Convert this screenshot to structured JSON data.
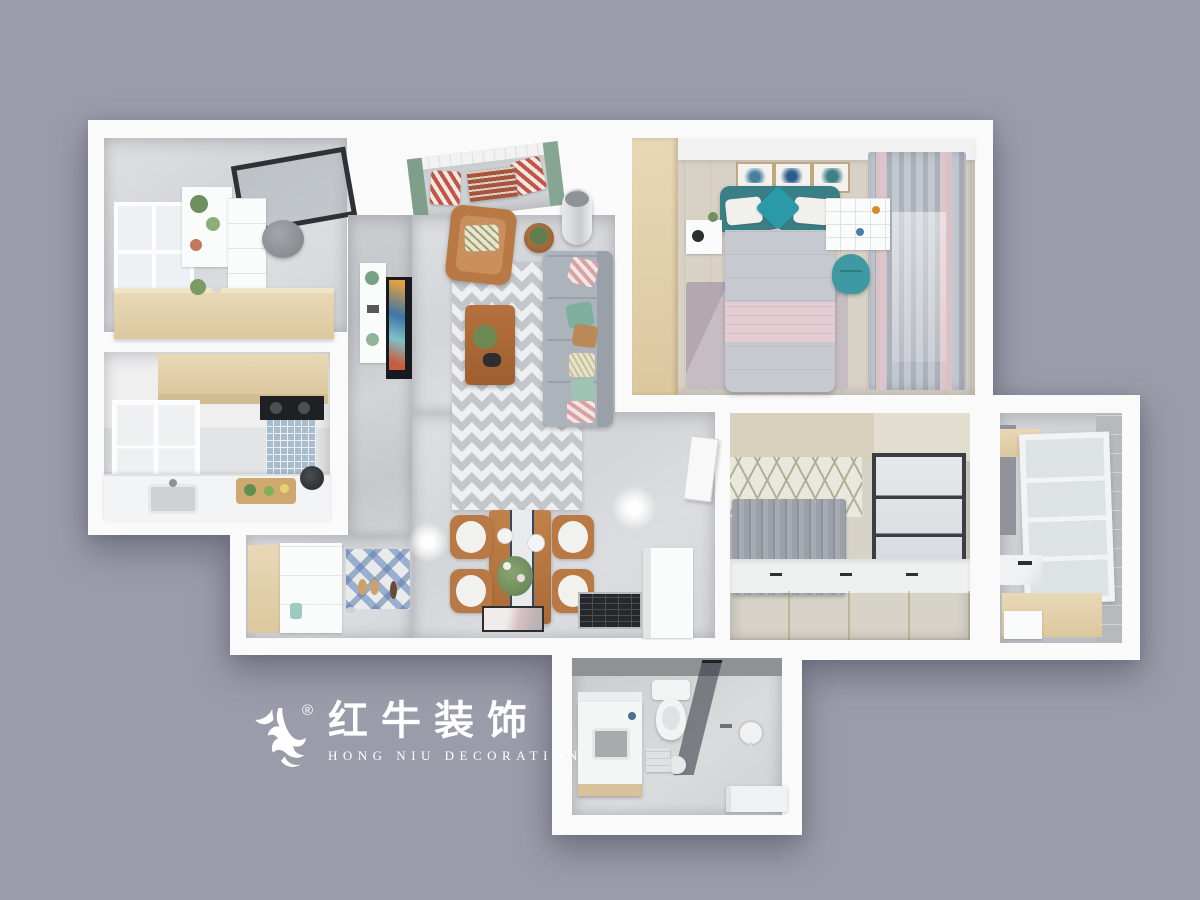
{
  "logo": {
    "brand": "红牛装饰",
    "subtitle": "HONG NIU DECORATION",
    "registered": "®",
    "mark": "bull-mark"
  },
  "palette": {
    "background": "#9a9ca9",
    "wall": "#fafafa",
    "floor_tile": "#d9dadc",
    "floor_wood": "#d8d1c5",
    "wood_light": "#e8d8b6",
    "wood_mid": "#b97944",
    "wood_dark": "#573a25",
    "sofa_gray": "#adb3ba",
    "teal": "#3a7e86",
    "teal_bright": "#2b9aa8",
    "pink": "#e5ccd2",
    "glass_dark": "#41464d",
    "rug_chevron": "#c3c7cb",
    "curtain_gray": "#c3c8cf",
    "curtain_pink": "#e2c4ca",
    "logo_white": "#ffffff"
  }
}
